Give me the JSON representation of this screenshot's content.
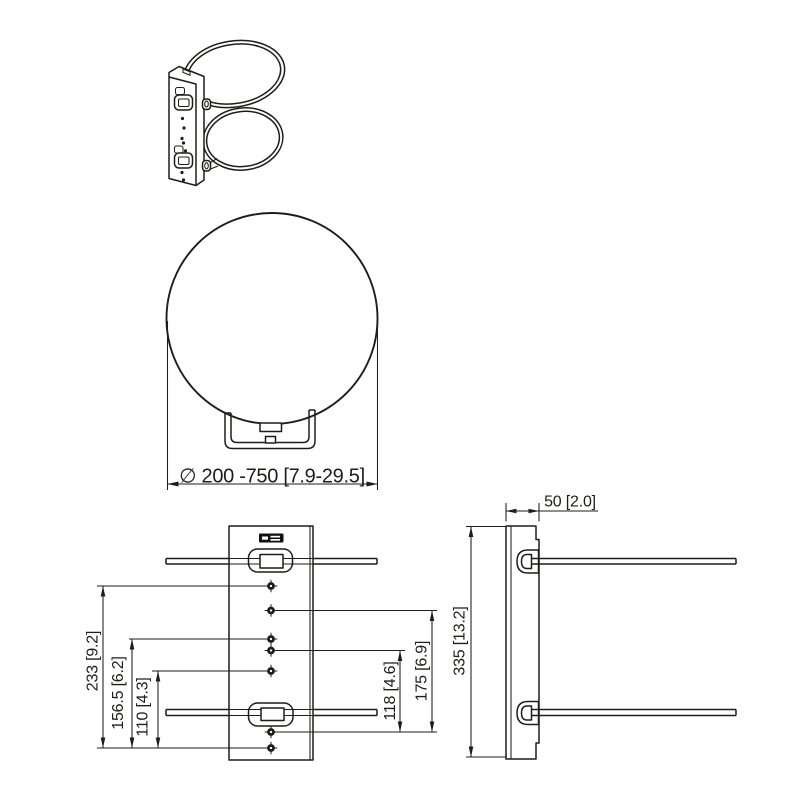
{
  "sheet": {
    "background": "#ffffff",
    "line_color": "#1d1d1b",
    "logo_color": "#111111"
  },
  "dimensions": {
    "pole_diameter": "∅ 200 -750 [7.9-29.5]",
    "front_left": [
      "233 [9.2]",
      "156.5 [6.2]",
      "110 [4.3]"
    ],
    "front_right": [
      "118 [4.6]",
      "175 [6.9]"
    ],
    "side_depth": "50 [2.0]",
    "side_height": "335 [13.2]"
  }
}
